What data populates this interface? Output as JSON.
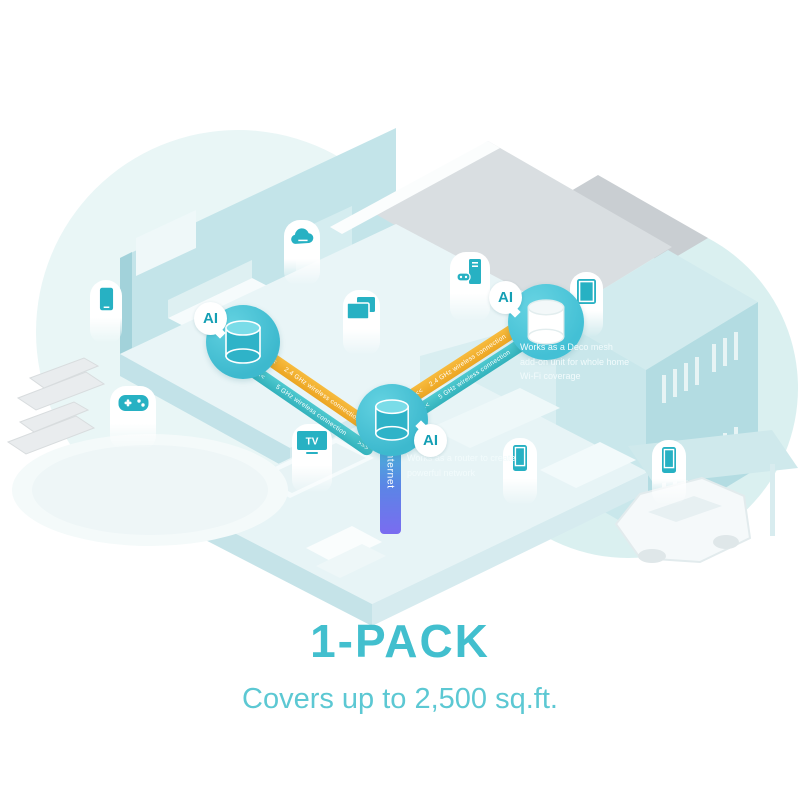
{
  "badges": {
    "ai": "AI"
  },
  "links": {
    "arrow_left": "<<<",
    "arrow_right": ">>>",
    "wireless_24": "2.4 GHz wireless connection",
    "wireless_5": "5 GHz wireless connection",
    "internet": "Internet"
  },
  "notes": {
    "router_unit": "Works as a router to create powerful network",
    "mesh_unit": "Works as a Deco mesh add-on unit for whole home Wi-Fi coverage"
  },
  "devices": {
    "tv_label": "TV",
    "icons": [
      "smartphone-icon",
      "game-controller-icon",
      "cloud-icon",
      "computer-screens-icon",
      "gaming-pc-icon",
      "tv-icon",
      "tablet-icon",
      "smartphone-icon",
      "smartphone-icon"
    ]
  },
  "footer": {
    "title": "1-PACK",
    "subtitle": "Covers up to 2,500 sq.ft."
  },
  "colors": {
    "accent_teal": "#42bfce",
    "subtitle_teal": "#5cc8d3",
    "band_orange": "#f0ae2e",
    "band_cyan": "#3fbfc8",
    "internet_top": "#47b8d6",
    "internet_bottom": "#7a6cf0",
    "ai_text": "#149fb4",
    "deco_circle": "#43c0d5",
    "house_wall": "#c3e4e9",
    "roof_gray": "#d9dee1"
  }
}
